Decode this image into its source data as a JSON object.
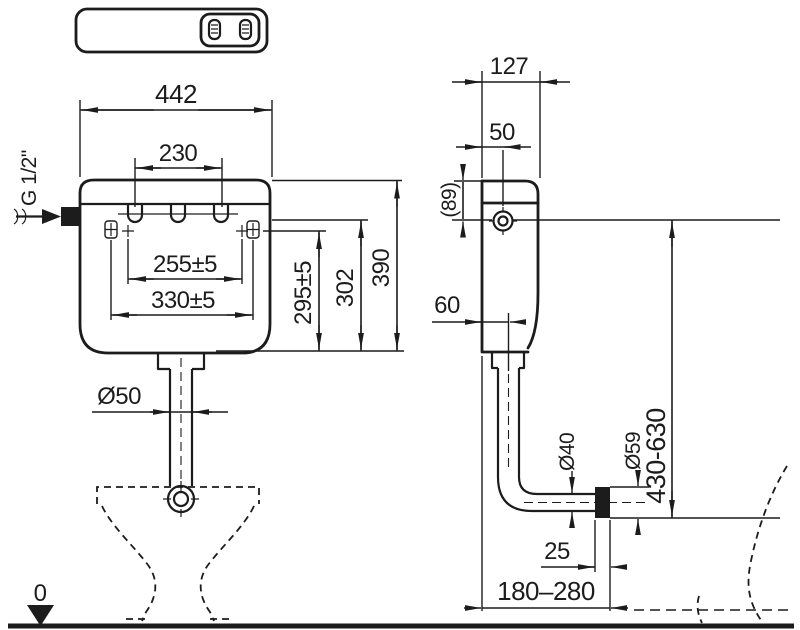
{
  "drawing": {
    "background": "#ffffff",
    "line_color": "#1c1c1c",
    "front_view": {
      "width_total": "442",
      "slot_spacing": "230",
      "inlet_thread": "G 1/2\"",
      "mount_spacing_inner": "255±5",
      "mount_spacing_outer": "330±5",
      "mount_height": "295±5",
      "inlet_height": "302",
      "total_height": "390",
      "flush_pipe_diameter": "Ø50",
      "datum_level": "0"
    },
    "side_view": {
      "depth_total": "127",
      "inlet_offset": "50",
      "inlet_depth": "(89)",
      "pipe_center_offset": "60",
      "outlet_height_range": "430-630",
      "pipe_diameter": "Ø40",
      "coupling_diameter": "Ø59",
      "coupling_length": "25",
      "wall_distance_range": "180–280"
    }
  }
}
